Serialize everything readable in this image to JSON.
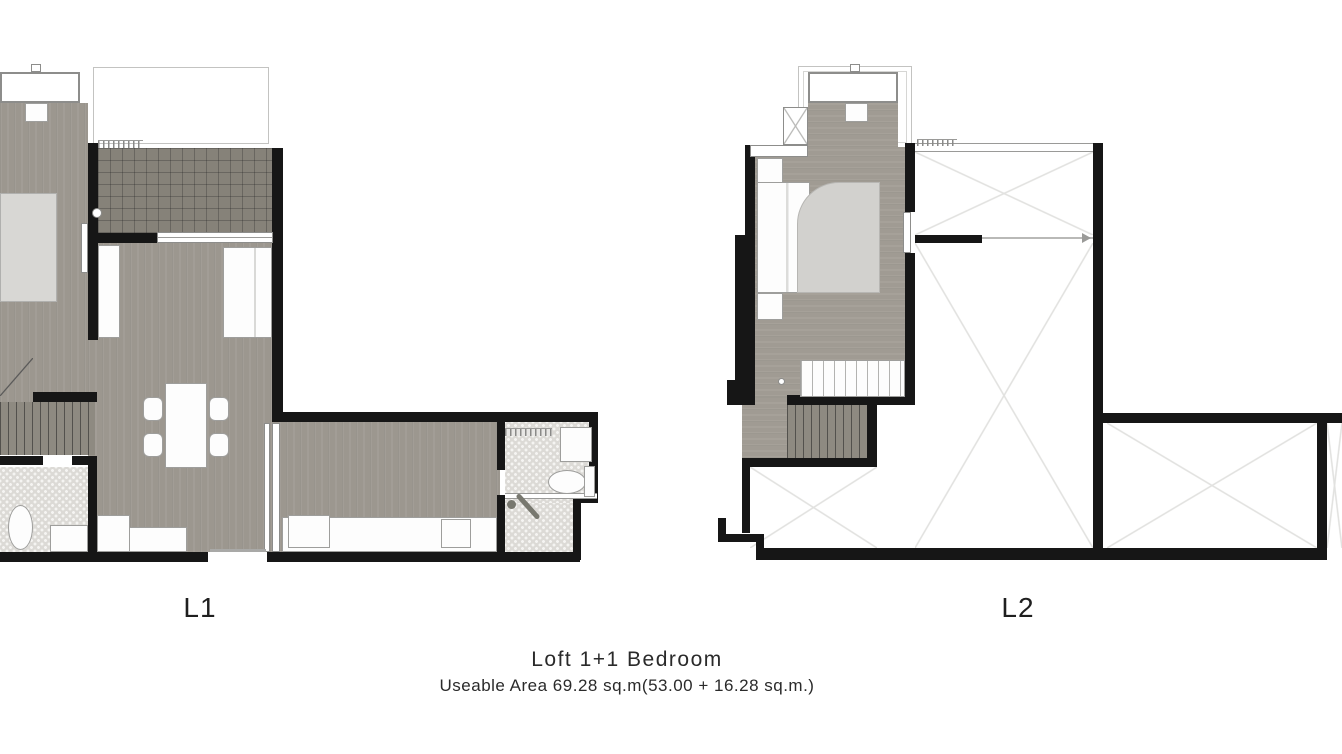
{
  "caption": {
    "title": "Loft 1+1 Bedroom",
    "subtitle": "Useable Area 69.28 sq.m(53.00 + 16.28 sq.m.)"
  },
  "labels": {
    "l1": "L1",
    "l2": "L2"
  },
  "colors": {
    "background": "#ffffff",
    "wall": "#161616",
    "wood_floor_l1": "#9c978f",
    "wood_floor_l2": "#a09b93",
    "balcony_tile": "#868279",
    "bathroom_tile": "#dcdad6",
    "stair_wood": "#8e8a81",
    "furniture": "#fdfdfd",
    "bed": "#d8d7d4",
    "duvet": "#d2d1ce",
    "void_line": "#e2e2e0"
  }
}
